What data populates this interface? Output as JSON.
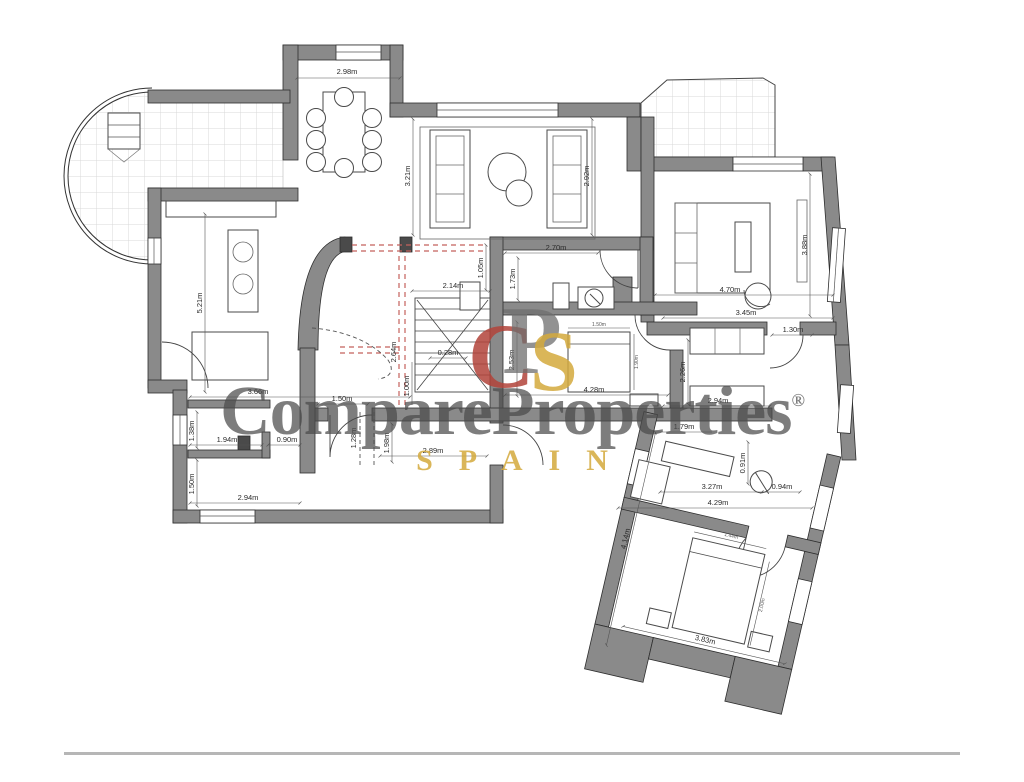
{
  "watermark": {
    "brand_part1": "Compare",
    "brand_part2": "Properties",
    "registered_mark": "®",
    "brand_sub": "SPAIN",
    "logo_letter_c": "C",
    "logo_letter_p": "P",
    "logo_letter_s": "S",
    "accent_red": "#b2433a",
    "accent_gold": "#d4a93c",
    "text_color": "#4b4b4b"
  },
  "plan": {
    "colors": {
      "wall": "#8a8a8a",
      "outline": "#2e2e2e",
      "tile_grid": "#d9d9d9",
      "dashed_red": "#c4615c",
      "dimension": "#2b2b2b"
    },
    "dimensions": [
      {
        "label": "2.98m"
      },
      {
        "label": "3.21m"
      },
      {
        "label": "2.92m"
      },
      {
        "label": "2.70m"
      },
      {
        "label": "1.73m"
      },
      {
        "label": "1.05m"
      },
      {
        "label": "2.14m"
      },
      {
        "label": "4.70m"
      },
      {
        "label": "3.45m"
      },
      {
        "label": "3.88m"
      },
      {
        "label": "1.30m"
      },
      {
        "label": "5.21m"
      },
      {
        "label": "3.66m"
      },
      {
        "label": "0.28m"
      },
      {
        "label": "2.64m"
      },
      {
        "label": "1.00m"
      },
      {
        "label": "2.53m"
      },
      {
        "label": "1.50m"
      },
      {
        "label": "1.28m"
      },
      {
        "label": "1.98m"
      },
      {
        "label": "2.89m"
      },
      {
        "label": "1.38m"
      },
      {
        "label": "1.94m"
      },
      {
        "label": "0.90m"
      },
      {
        "label": "1.50m"
      },
      {
        "label": "2.94m"
      },
      {
        "label": "4.28m"
      },
      {
        "label": "2.26m"
      },
      {
        "label": "2.94m"
      },
      {
        "label": "1.79m"
      },
      {
        "label": "0.91m"
      },
      {
        "label": "3.27m"
      },
      {
        "label": "0.94m"
      },
      {
        "label": "4.29m"
      },
      {
        "label": "3.83m"
      },
      {
        "label": "4.14m"
      },
      {
        "label": "1.50m"
      },
      {
        "label": "1.90m"
      },
      {
        "label": "1.44m"
      },
      {
        "label": "2.00m"
      }
    ]
  }
}
